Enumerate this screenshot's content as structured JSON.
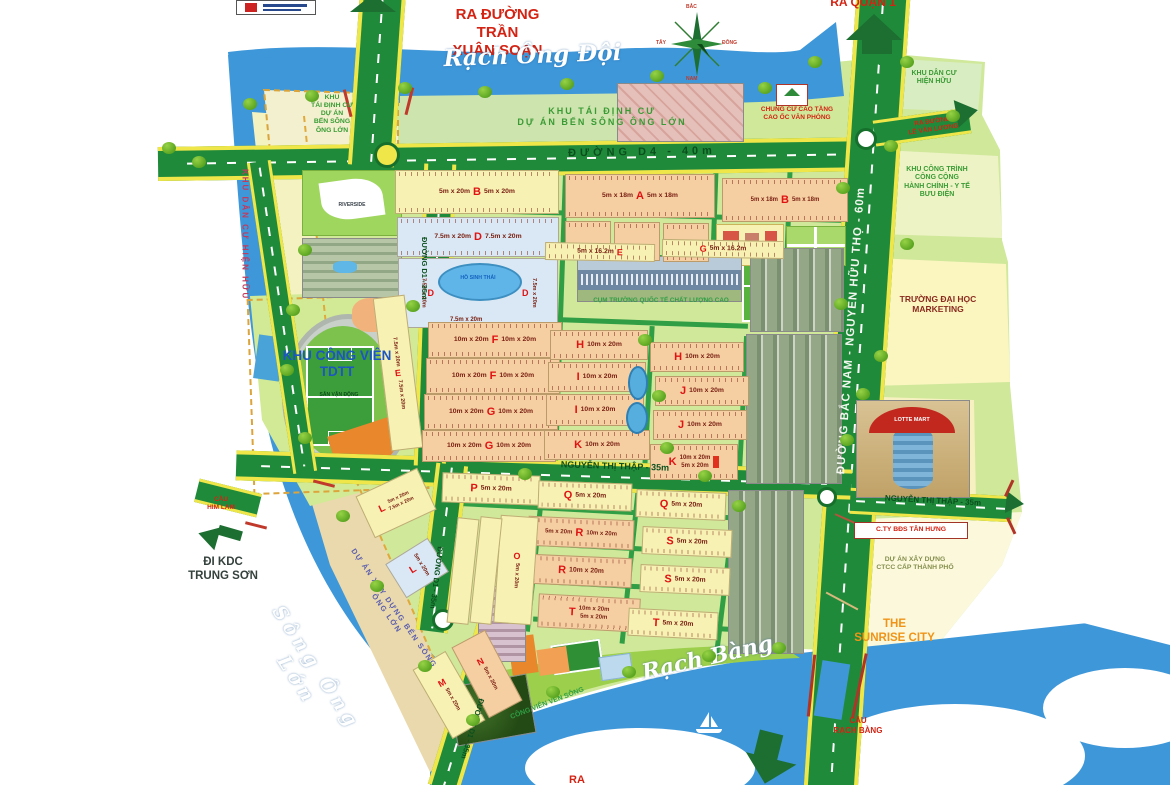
{
  "water": {
    "rach_ong_doi": "Rạch   Ông   Đội",
    "song_ong_lon": "Sông Ông Lớn",
    "rach_bang": "Rạch   Bàng"
  },
  "roads": {
    "d4": "ĐƯỜNG D4  -  40m",
    "bac_nam": "ĐƯỜNG BẮC NAM - NGUYỄN HỮU THỌ - 60m",
    "ntt": "NGUYỄN THỊ THẬP - 35m",
    "ntt_right": "NGUYỄN THỊ THẬP - 35m",
    "d1_upper": "ĐƯỜNG D1 - 35m",
    "d1_mid": "ĐƯỜNG D1 - 35m",
    "d1_lower": "ĐƯỜNG D1 - 35m"
  },
  "exits": {
    "quan1": "RA QUẬN 1",
    "tran_xuan_soan": "RA ĐƯỜNG\nTRẦN\nXUÂN SOẠN",
    "le_van_luong": "RA ĐƯỜNG\nLÊ VĂN LƯƠNG",
    "kdc_trung_son": "ĐI KDC\nTRUNG SƠN",
    "ra_south": "RA"
  },
  "bridges": {
    "him_lam": "CẦU\nHIM LAM",
    "rach_bang": "CẦU\nRẠCH BÀNG"
  },
  "zones": {
    "resettle_small": "KHU\nTÁI ĐỊNH CƯ\nDỰ ÁN\nBẾN SÔNG\nÔNG LỚN",
    "resettle_large": "KHU TÁI ĐỊNH CƯ\nDỰ ÁN BẾN SÔNG ÔNG LỚN",
    "chung_cu": "CHUNG CƯ CAO TẦNG\nCAO ỐC VĂN PHÒNG",
    "kdc_hien_huu_ne": "KHU DÂN CƯ\nHIỆN HỮU",
    "kdc_hien_huu_w": "KHU DÂN CƯ HIỆN HỮU",
    "cong_trinh": "KHU CÔNG TRÌNH\nCÔNG CỘNG\nHÀNH CHÍNH - Y TẾ\nBƯU ĐIỆN",
    "dai_hoc_marketing": "TRƯỜNG ĐẠI HỌC\nMARKETING",
    "tan_hung": "C.TY BĐS TÂN HƯNG",
    "ctcc": "DỰ ÁN XÂY DỰNG\nCTCC CẤP THÀNH PHỐ",
    "sunrise": "THE\nSUNRISE CITY",
    "cong_vien_tdtt": "KHU CÔNG VIÊN\nTDTT",
    "san_van_dong": "SÂN VẬN ĐỘNG",
    "truong_quoc_te": "CỤM TRƯỜNG QUỐC TẾ CHẤT LƯỢNG CAO",
    "ho_sinh_thai": "HỒ SINH THÁI",
    "cong_vien_ven_song": "CÔNG VIÊN VEN SÔNG",
    "ben_song": "DỰ ÁN XÂY DỰNG BẾN SÔNG ÔNG LỚN"
  },
  "compass": {
    "north": "BẮC",
    "south": "NAM",
    "east": "ĐÔNG",
    "west": "TÂY"
  },
  "landmarks": {
    "lotte": "LOTTE MART",
    "riverside": "RIVERSIDE"
  },
  "colors": {
    "road_green": "#1f8b3a",
    "road_edge_yellow": "#efe64a",
    "water_blue": "#3e97d9",
    "block_letter_red": "#e01212",
    "block_salmon": "#f5cfa2",
    "land_green": "#cfe89a"
  },
  "blocks": [
    {
      "letter": "B",
      "d1": "5m x 20m",
      "d2": "5m x 20m"
    },
    {
      "letter": "A",
      "d1": "5m x 18m",
      "d2": "5m x 18m"
    },
    {
      "letter": "B",
      "d1": "5m x 18m",
      "d2": "5m x 18m"
    },
    {
      "letter": "D",
      "d1": "7.5m x 20m",
      "d2": "7.5m x 20m"
    },
    {
      "letter": "D",
      "d1": "7.5m x 20m"
    },
    {
      "letter": "D",
      "d1": "7.5m x 20m"
    },
    {
      "letter": "E",
      "d1": "5m x 16.2m"
    },
    {
      "letter": "G",
      "d1": "5m x 16.2m"
    },
    {
      "letter": "E",
      "d1": "7.5m x 20m"
    },
    {
      "letter": "F",
      "d1": "10m x 20m",
      "d2": "10m x 20m"
    },
    {
      "letter": "F",
      "d1": "10m x 20m",
      "d2": "10m x 20m"
    },
    {
      "letter": "G",
      "d1": "10m x 20m",
      "d2": "10m x 20m"
    },
    {
      "letter": "G",
      "d1": "10m x 20m",
      "d2": "10m x 20m"
    },
    {
      "letter": "H",
      "d1": "10m x 20m"
    },
    {
      "letter": "H",
      "d1": "10m x 20m"
    },
    {
      "letter": "I",
      "d1": "10m x 20m"
    },
    {
      "letter": "I",
      "d1": "10m x 20m"
    },
    {
      "letter": "J",
      "d1": "10m x 20m"
    },
    {
      "letter": "J",
      "d1": "10m x 20m"
    },
    {
      "letter": "K",
      "d1": "10m x 20m"
    },
    {
      "letter": "K",
      "d1": "10m x 20m",
      "d2": "5m x 20m"
    },
    {
      "letter": "P",
      "d1": "5m x 20m"
    },
    {
      "letter": "Q",
      "d1": "5m x 20m"
    },
    {
      "letter": "Q",
      "d1": "5m x 20m"
    },
    {
      "letter": "R",
      "d1": "5m x 20m",
      "d2": "10m x 20m"
    },
    {
      "letter": "R",
      "d1": "10m x 20m"
    },
    {
      "letter": "S",
      "d1": "5m x 20m"
    },
    {
      "letter": "S",
      "d1": "5m x 20m"
    },
    {
      "letter": "T",
      "d1": "10m x 20m",
      "d2": "5m x 20m"
    },
    {
      "letter": "T",
      "d1": "5m x 20m"
    },
    {
      "letter": "O",
      "d1": "5m x 20m"
    },
    {
      "letter": "L",
      "d1": "5m x 20m",
      "d2": "7.5m x 20m"
    },
    {
      "letter": "L",
      "d1": "5m x 20m"
    },
    {
      "letter": "M",
      "d1": "5m x 20m"
    },
    {
      "letter": "N",
      "d1": "5m x 20m"
    }
  ]
}
